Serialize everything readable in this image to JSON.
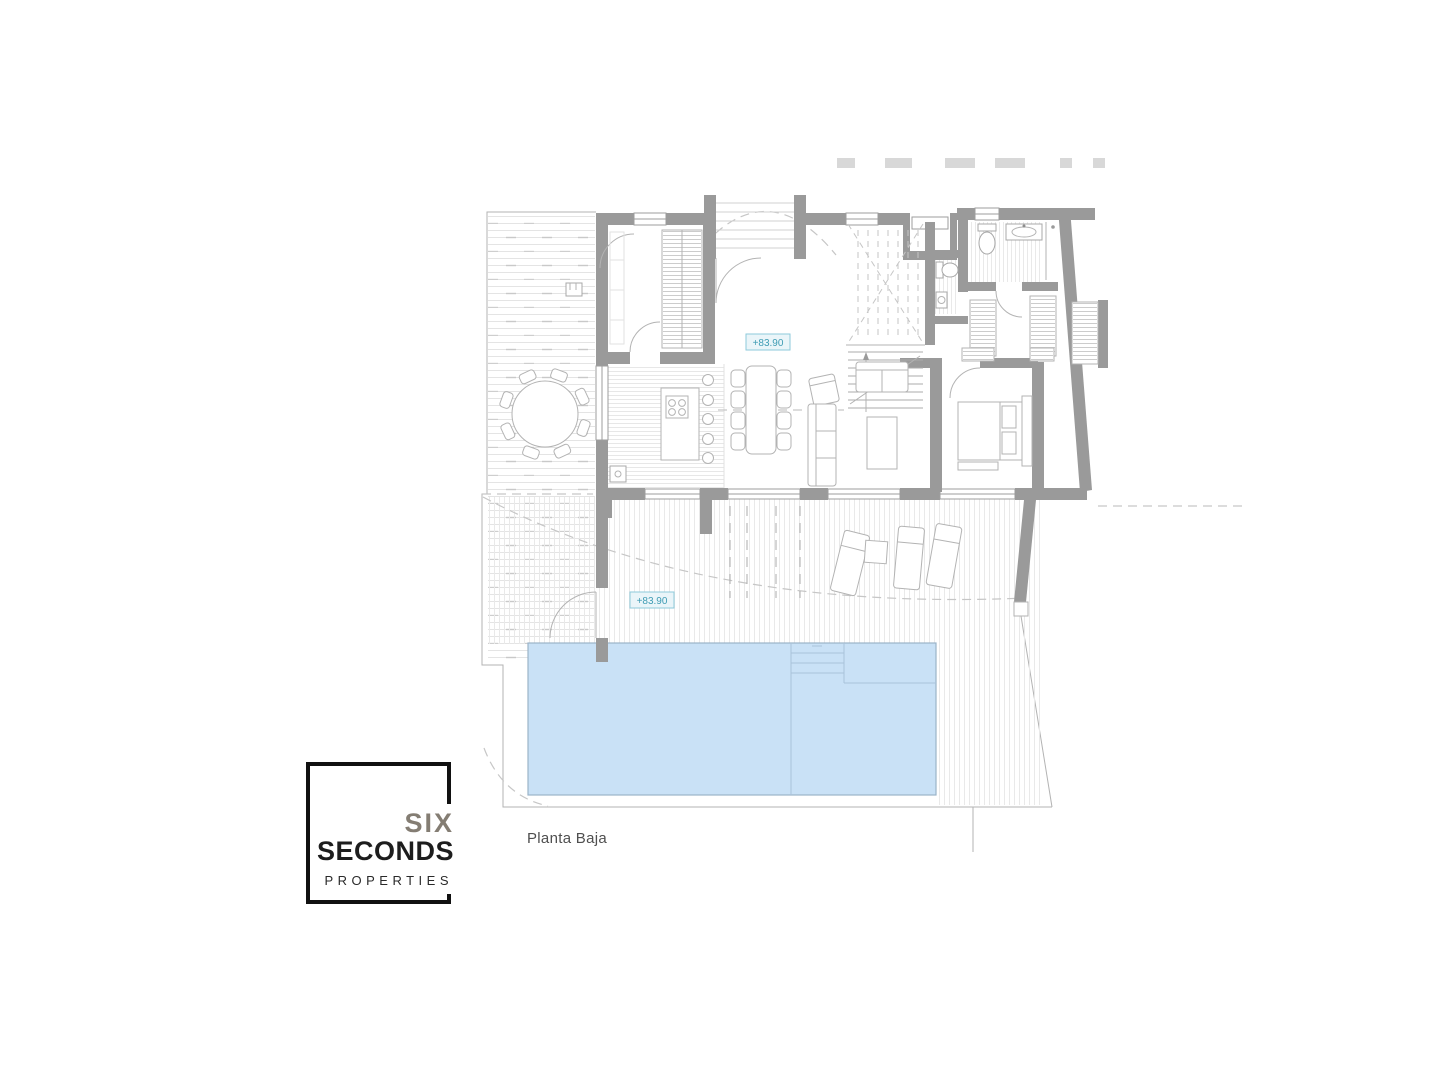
{
  "colors": {
    "wall": "#9a9a9a",
    "line": "#b3b3b3",
    "line-light": "#e2e2e2",
    "dash": "#c6c6c6",
    "pool-fill": "#c9e1f6",
    "pool-stroke": "#9bb3c9",
    "pool-line": "#a9c3da",
    "label-teal": "#3f9cb4",
    "label-bg": "#eaf5f9",
    "label-border": "#8ecadb",
    "logo-accent": "#847d73",
    "logo-dark": "#1d1d1d",
    "text": "#4f4f4f"
  },
  "plan": {
    "caption": "Planta Baja",
    "elevation_main": "+83.90",
    "elevation_terrace": "+83.90"
  },
  "logo": {
    "top": "SIX",
    "middle": "SECONDS",
    "bottom": "PROPERTIES"
  }
}
